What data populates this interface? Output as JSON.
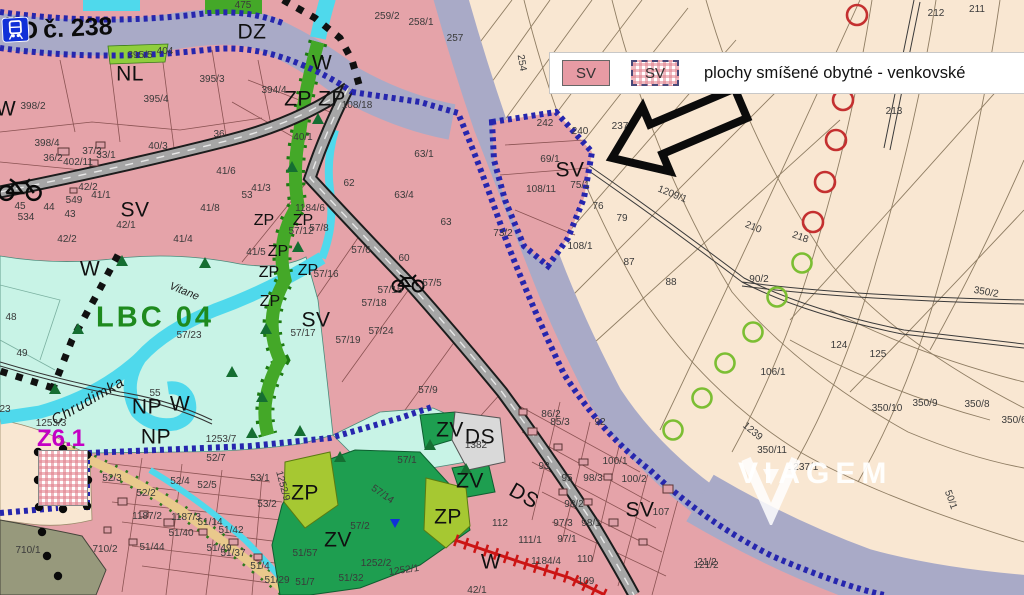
{
  "railway": {
    "cd": "ČD",
    "number": "č. 238"
  },
  "legend": {
    "swatch_filled_label": "SV",
    "swatch_hatched_label": "SV",
    "description": "plochy smíšené obytné - venkovské"
  },
  "watermark": {
    "name": "VIAGEM"
  },
  "map": {
    "colors": {
      "residential_pink": "#e5a3a9",
      "field_cream": "#f9e7d2",
      "rail_corridor": "#a9aac7",
      "biocenter_cyan": "#c8f3e6",
      "river_cyan": "#4fd9ec",
      "green_strip": "#44a828",
      "yellow_green": "#a6c832",
      "park_green": "#1e9e50",
      "olive": "#97997c",
      "transport_gray": "#d9d9d9",
      "boundary_blue": "#2626ae",
      "magenta": "#c400c4",
      "lbc_green": "#1e8a1e",
      "red_marker": "#c43030",
      "green_marker": "#7cbe33"
    },
    "labels": [
      {
        "t": "DZ",
        "x": 252,
        "y": 32,
        "c": "z"
      },
      {
        "t": "NL",
        "x": 130,
        "y": 74,
        "c": "z"
      },
      {
        "t": "W",
        "x": 322,
        "y": 63,
        "c": "z"
      },
      {
        "t": "W",
        "x": 6,
        "y": 109,
        "c": "z"
      },
      {
        "t": "ZP",
        "x": 298,
        "y": 99,
        "c": "z"
      },
      {
        "t": "ZP",
        "x": 332,
        "y": 99,
        "c": "z"
      },
      {
        "t": "SV",
        "x": 135,
        "y": 210,
        "c": "z"
      },
      {
        "t": "SV",
        "x": 316,
        "y": 320,
        "c": "z"
      },
      {
        "t": "SV",
        "x": 570,
        "y": 170,
        "c": "z"
      },
      {
        "t": "W",
        "x": 90,
        "y": 269,
        "c": "z"
      },
      {
        "t": "NP",
        "x": 147,
        "y": 407,
        "c": "z"
      },
      {
        "t": "W",
        "x": 180,
        "y": 404,
        "c": "z"
      },
      {
        "t": "NP",
        "x": 156,
        "y": 437,
        "c": "z"
      },
      {
        "t": "SV",
        "x": 67,
        "y": 487,
        "c": "zs"
      },
      {
        "t": "ZP",
        "x": 305,
        "y": 493,
        "c": "z"
      },
      {
        "t": "ZV",
        "x": 450,
        "y": 430,
        "c": "z"
      },
      {
        "t": "DS",
        "x": 480,
        "y": 437,
        "c": "z"
      },
      {
        "t": "ZV",
        "x": 470,
        "y": 481,
        "c": "z"
      },
      {
        "t": "ZP",
        "x": 448,
        "y": 517,
        "c": "z"
      },
      {
        "t": "DS",
        "x": 524,
        "y": 496,
        "c": "z",
        "r": 30
      },
      {
        "t": "ZV",
        "x": 338,
        "y": 540,
        "c": "z"
      },
      {
        "t": "W",
        "x": 491,
        "y": 562,
        "c": "z"
      },
      {
        "t": "SV",
        "x": 640,
        "y": 510,
        "c": "z"
      },
      {
        "t": "ZP",
        "x": 264,
        "y": 221,
        "c": "zs"
      },
      {
        "t": "ZP",
        "x": 303,
        "y": 221,
        "c": "zs"
      },
      {
        "t": "ZP",
        "x": 278,
        "y": 252,
        "c": "zs"
      },
      {
        "t": "ZP",
        "x": 269,
        "y": 273,
        "c": "zs"
      },
      {
        "t": "ZP",
        "x": 308,
        "y": 271,
        "c": "zs"
      },
      {
        "t": "ZP",
        "x": 270,
        "y": 302,
        "c": "zs"
      },
      {
        "t": "LBC 04",
        "x": 155,
        "y": 318,
        "c": "lbc"
      },
      {
        "t": "Z6.1",
        "x": 61,
        "y": 439,
        "c": "z61"
      },
      {
        "t": "Chrudimka",
        "x": 88,
        "y": 401,
        "c": "riv",
        "r": -30
      },
      {
        "t": "Vitane",
        "x": 184,
        "y": 292,
        "c": "rivs",
        "r": 22
      },
      {
        "t": "475",
        "x": 243,
        "y": 6
      },
      {
        "t": "398/2",
        "x": 33,
        "y": 107
      },
      {
        "t": "395/5",
        "x": 140,
        "y": 56
      },
      {
        "t": "404",
        "x": 165,
        "y": 52
      },
      {
        "t": "395/3",
        "x": 212,
        "y": 80
      },
      {
        "t": "395/4",
        "x": 156,
        "y": 100
      },
      {
        "t": "394/4",
        "x": 274,
        "y": 91
      },
      {
        "t": "398/4",
        "x": 47,
        "y": 144
      },
      {
        "t": "36/2",
        "x": 53,
        "y": 159
      },
      {
        "t": "37/2",
        "x": 92,
        "y": 152
      },
      {
        "t": "33/1",
        "x": 106,
        "y": 156
      },
      {
        "t": "402/11",
        "x": 78,
        "y": 163
      },
      {
        "t": "40/3",
        "x": 158,
        "y": 147
      },
      {
        "t": "36",
        "x": 219,
        "y": 135
      },
      {
        "t": "41/6",
        "x": 226,
        "y": 172
      },
      {
        "t": "41/8",
        "x": 210,
        "y": 209
      },
      {
        "t": "42/2",
        "x": 88,
        "y": 188
      },
      {
        "t": "41/1",
        "x": 101,
        "y": 196
      },
      {
        "t": "549",
        "x": 74,
        "y": 201
      },
      {
        "t": "45",
        "x": 20,
        "y": 207
      },
      {
        "t": "44",
        "x": 49,
        "y": 208
      },
      {
        "t": "43",
        "x": 70,
        "y": 215
      },
      {
        "t": "534",
        "x": 26,
        "y": 218
      },
      {
        "t": "42/1",
        "x": 126,
        "y": 226
      },
      {
        "t": "42/2",
        "x": 67,
        "y": 240
      },
      {
        "t": "41/4",
        "x": 183,
        "y": 240
      },
      {
        "t": "108/18",
        "x": 357,
        "y": 106
      },
      {
        "t": "63/1",
        "x": 424,
        "y": 155
      },
      {
        "t": "40/1",
        "x": 303,
        "y": 138
      },
      {
        "t": "259/2",
        "x": 387,
        "y": 17
      },
      {
        "t": "258/1",
        "x": 421,
        "y": 23
      },
      {
        "t": "257",
        "x": 455,
        "y": 39
      },
      {
        "t": "254",
        "x": 521,
        "y": 63,
        "r": 80
      },
      {
        "t": "212",
        "x": 936,
        "y": 14
      },
      {
        "t": "211",
        "x": 977,
        "y": 10
      },
      {
        "t": "213",
        "x": 894,
        "y": 112
      },
      {
        "t": "242",
        "x": 545,
        "y": 124
      },
      {
        "t": "240",
        "x": 580,
        "y": 132
      },
      {
        "t": "237",
        "x": 620,
        "y": 127
      },
      {
        "t": "69/1",
        "x": 550,
        "y": 160
      },
      {
        "t": "75/1",
        "x": 580,
        "y": 186
      },
      {
        "t": "108/11",
        "x": 541,
        "y": 190
      },
      {
        "t": "76",
        "x": 598,
        "y": 207
      },
      {
        "t": "79",
        "x": 622,
        "y": 219
      },
      {
        "t": "73/2",
        "x": 503,
        "y": 234
      },
      {
        "t": "108/1",
        "x": 580,
        "y": 247
      },
      {
        "t": "87",
        "x": 629,
        "y": 263
      },
      {
        "t": "88",
        "x": 671,
        "y": 283
      },
      {
        "t": "90/2",
        "x": 759,
        "y": 280
      },
      {
        "t": "1209/1",
        "x": 672,
        "y": 195,
        "r": 22
      },
      {
        "t": "210",
        "x": 753,
        "y": 228,
        "r": 22
      },
      {
        "t": "218",
        "x": 800,
        "y": 238,
        "r": 20
      },
      {
        "t": "350/2",
        "x": 986,
        "y": 293,
        "r": 10
      },
      {
        "t": "48",
        "x": 11,
        "y": 318
      },
      {
        "t": "49",
        "x": 22,
        "y": 354
      },
      {
        "t": "55",
        "x": 155,
        "y": 394
      },
      {
        "t": "23",
        "x": 5,
        "y": 410
      },
      {
        "t": "57/23",
        "x": 189,
        "y": 336
      },
      {
        "t": "1253/3",
        "x": 51,
        "y": 424
      },
      {
        "t": "1253/7",
        "x": 221,
        "y": 440
      },
      {
        "t": "41/3",
        "x": 261,
        "y": 189
      },
      {
        "t": "53",
        "x": 247,
        "y": 196
      },
      {
        "t": "1184/6",
        "x": 310,
        "y": 209
      },
      {
        "t": "57/12",
        "x": 301,
        "y": 232
      },
      {
        "t": "57/8",
        "x": 319,
        "y": 229
      },
      {
        "t": "41/5",
        "x": 256,
        "y": 253
      },
      {
        "t": "57/16",
        "x": 326,
        "y": 275
      },
      {
        "t": "57/6",
        "x": 361,
        "y": 251
      },
      {
        "t": "62",
        "x": 349,
        "y": 184
      },
      {
        "t": "63/4",
        "x": 404,
        "y": 196
      },
      {
        "t": "63",
        "x": 446,
        "y": 223
      },
      {
        "t": "60",
        "x": 404,
        "y": 259
      },
      {
        "t": "57/5",
        "x": 432,
        "y": 284
      },
      {
        "t": "57/15",
        "x": 390,
        "y": 291
      },
      {
        "t": "57/18",
        "x": 374,
        "y": 304
      },
      {
        "t": "57/17",
        "x": 303,
        "y": 334
      },
      {
        "t": "57/24",
        "x": 381,
        "y": 332
      },
      {
        "t": "57/19",
        "x": 348,
        "y": 341
      },
      {
        "t": "57/9",
        "x": 428,
        "y": 391
      },
      {
        "t": "52/7",
        "x": 216,
        "y": 459
      },
      {
        "t": "52/5",
        "x": 207,
        "y": 486
      },
      {
        "t": "52/3",
        "x": 112,
        "y": 479
      },
      {
        "t": "52/4",
        "x": 180,
        "y": 482
      },
      {
        "t": "52/2",
        "x": 146,
        "y": 494
      },
      {
        "t": "53/1",
        "x": 260,
        "y": 479
      },
      {
        "t": "53/2",
        "x": 267,
        "y": 505
      },
      {
        "t": "949/8",
        "x": 74,
        "y": 457
      },
      {
        "t": "1187/2",
        "x": 147,
        "y": 517
      },
      {
        "t": "1187/3",
        "x": 186,
        "y": 518
      },
      {
        "t": "51/14",
        "x": 210,
        "y": 523
      },
      {
        "t": "51/40",
        "x": 181,
        "y": 534
      },
      {
        "t": "51/42",
        "x": 231,
        "y": 531
      },
      {
        "t": "51/44",
        "x": 152,
        "y": 548
      },
      {
        "t": "51/49",
        "x": 219,
        "y": 549
      },
      {
        "t": "51/37",
        "x": 233,
        "y": 554
      },
      {
        "t": "51/4",
        "x": 260,
        "y": 567
      },
      {
        "t": "51/29",
        "x": 277,
        "y": 581
      },
      {
        "t": "51/7",
        "x": 305,
        "y": 583
      },
      {
        "t": "51/57",
        "x": 305,
        "y": 554
      },
      {
        "t": "51/32",
        "x": 351,
        "y": 579
      },
      {
        "t": "710/1",
        "x": 28,
        "y": 551
      },
      {
        "t": "710/2",
        "x": 105,
        "y": 550
      },
      {
        "t": "1252/9",
        "x": 282,
        "y": 486,
        "r": 75
      },
      {
        "t": "1252/2",
        "x": 376,
        "y": 564
      },
      {
        "t": "1252/1",
        "x": 404,
        "y": 571,
        "r": -8
      },
      {
        "t": "57/2",
        "x": 360,
        "y": 527
      },
      {
        "t": "57/1",
        "x": 407,
        "y": 461
      },
      {
        "t": "57/14",
        "x": 382,
        "y": 495,
        "r": 35
      },
      {
        "t": "1382",
        "x": 476,
        "y": 446
      },
      {
        "t": "86/2",
        "x": 551,
        "y": 415
      },
      {
        "t": "85/3",
        "x": 560,
        "y": 423
      },
      {
        "t": "92",
        "x": 600,
        "y": 423
      },
      {
        "t": "93",
        "x": 544,
        "y": 467
      },
      {
        "t": "95",
        "x": 567,
        "y": 479
      },
      {
        "t": "98/3",
        "x": 593,
        "y": 479
      },
      {
        "t": "100/1",
        "x": 615,
        "y": 462
      },
      {
        "t": "100/2",
        "x": 634,
        "y": 480
      },
      {
        "t": "97/3",
        "x": 563,
        "y": 524
      },
      {
        "t": "98/1",
        "x": 591,
        "y": 524
      },
      {
        "t": "98/2",
        "x": 574,
        "y": 505
      },
      {
        "t": "97/1",
        "x": 567,
        "y": 540
      },
      {
        "t": "111/1",
        "x": 530,
        "y": 541
      },
      {
        "t": "112",
        "x": 500,
        "y": 524
      },
      {
        "t": "1184/4",
        "x": 546,
        "y": 562
      },
      {
        "t": "110",
        "x": 585,
        "y": 560
      },
      {
        "t": "109",
        "x": 586,
        "y": 582
      },
      {
        "t": "42/1",
        "x": 477,
        "y": 591
      },
      {
        "t": "121/2",
        "x": 706,
        "y": 566
      },
      {
        "t": "107",
        "x": 661,
        "y": 513
      },
      {
        "t": "106/1",
        "x": 773,
        "y": 373
      },
      {
        "t": "124",
        "x": 839,
        "y": 346
      },
      {
        "t": "125",
        "x": 878,
        "y": 355
      },
      {
        "t": "350/10",
        "x": 887,
        "y": 409
      },
      {
        "t": "350/9",
        "x": 925,
        "y": 404
      },
      {
        "t": "350/8",
        "x": 977,
        "y": 405
      },
      {
        "t": "350/6",
        "x": 1014,
        "y": 421
      },
      {
        "t": "350/11",
        "x": 772,
        "y": 451
      },
      {
        "t": "1237/1",
        "x": 803,
        "y": 468
      },
      {
        "t": "21/2",
        "x": 707,
        "y": 563
      },
      {
        "t": "50/1",
        "x": 950,
        "y": 500,
        "r": 70
      },
      {
        "t": "1239",
        "x": 752,
        "y": 432,
        "r": 40
      }
    ],
    "markers": {
      "red_circles": [
        [
          857,
          15
        ],
        [
          843,
          100
        ],
        [
          836,
          140
        ],
        [
          825,
          182
        ],
        [
          813,
          222
        ]
      ],
      "green_circles": [
        [
          802,
          263
        ],
        [
          777,
          297
        ],
        [
          753,
          332
        ],
        [
          725,
          363
        ],
        [
          702,
          398
        ],
        [
          673,
          430
        ]
      ],
      "boundary_dots": [
        [
          38,
          452
        ],
        [
          63,
          449
        ],
        [
          87,
          455
        ],
        [
          88,
          480
        ],
        [
          87,
          506
        ],
        [
          63,
          509
        ],
        [
          39,
          507
        ],
        [
          38,
          480
        ],
        [
          42,
          532
        ],
        [
          47,
          556
        ],
        [
          58,
          576
        ]
      ],
      "trees": [
        [
          122,
          262
        ],
        [
          205,
          264
        ],
        [
          78,
          330
        ],
        [
          55,
          390
        ],
        [
          232,
          373
        ],
        [
          252,
          434
        ],
        [
          300,
          432
        ],
        [
          340,
          458
        ],
        [
          430,
          446
        ],
        [
          466,
          470
        ],
        [
          318,
          120
        ],
        [
          292,
          168
        ],
        [
          298,
          248
        ],
        [
          266,
          330
        ],
        [
          262,
          398
        ]
      ],
      "buildings": [
        [
          58,
          148,
          11,
          7
        ],
        [
          96,
          142,
          9,
          6
        ],
        [
          118,
          498,
          9,
          7
        ],
        [
          140,
          511,
          8,
          6
        ],
        [
          164,
          519,
          10,
          7
        ],
        [
          199,
          529,
          8,
          6
        ],
        [
          229,
          539,
          9,
          6
        ],
        [
          254,
          554,
          8,
          6
        ],
        [
          129,
          539,
          8,
          6
        ],
        [
          104,
          527,
          7,
          6
        ],
        [
          528,
          428,
          9,
          7
        ],
        [
          554,
          444,
          8,
          6
        ],
        [
          579,
          459,
          9,
          6
        ],
        [
          604,
          474,
          8,
          6
        ],
        [
          559,
          489,
          8,
          6
        ],
        [
          584,
          499,
          8,
          6
        ],
        [
          609,
          519,
          9,
          7
        ],
        [
          639,
          539,
          8,
          6
        ],
        [
          519,
          409,
          8,
          6
        ],
        [
          663,
          485,
          10,
          8
        ],
        [
          90,
          160,
          8,
          6
        ],
        [
          70,
          188,
          7,
          5
        ]
      ]
    }
  }
}
